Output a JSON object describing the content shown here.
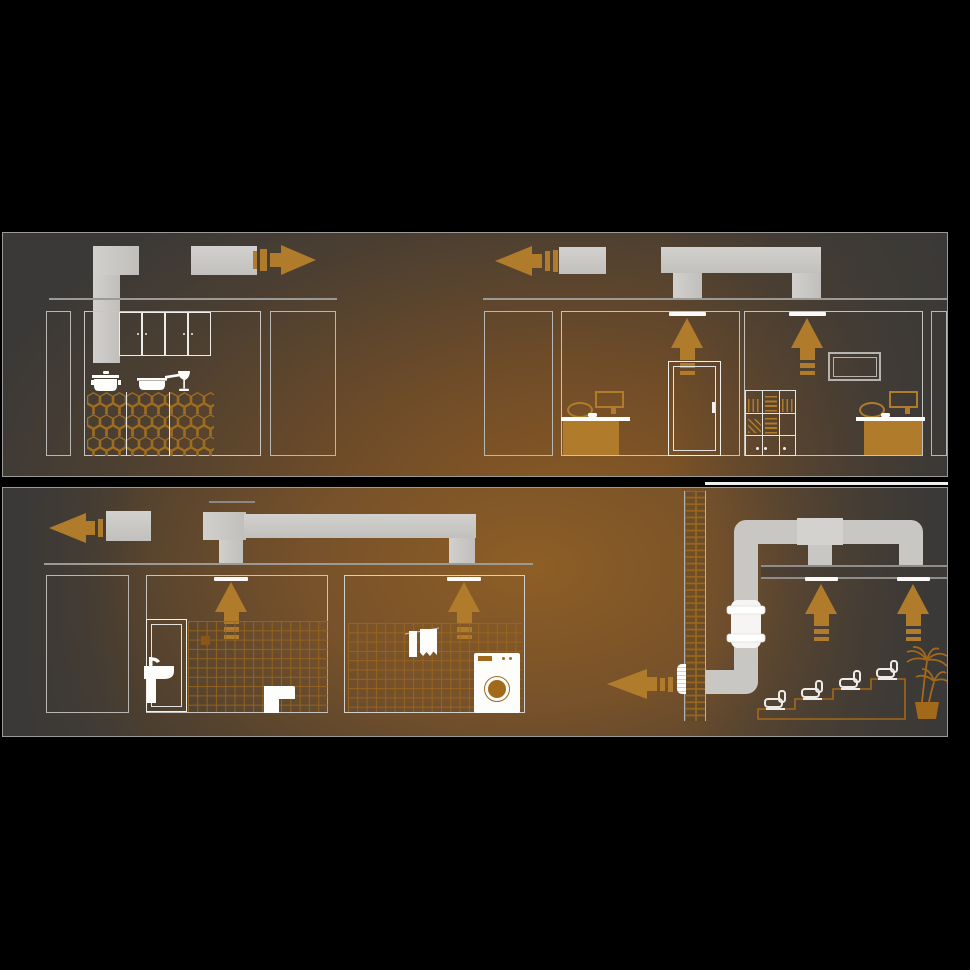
{
  "palette": {
    "accent": "#b07b2b",
    "duct_gray": "#c8c6c3",
    "panel_dark": "#3b3937",
    "glow_orange": "#8a5a23",
    "white": "#fbfaf9",
    "line_gray": "#9c9a97",
    "fixture_white": "#fdfdfc",
    "tile_line": "#9b671d",
    "plant_orange": "#a2691b",
    "page_background": "#000000"
  },
  "panels": [
    {
      "name": "upper-floor",
      "scenes": [
        {
          "name": "kitchen",
          "airflow": "extracted via cooker-hood duct, exhausted to the right",
          "icons": [
            "cooker-hood-duct",
            "exhaust-duct",
            "airflow-arrow-right",
            "wall-cabinets",
            "cooking-pot",
            "frying-pan",
            "wine-glass",
            "hex-tiled-counter"
          ]
        },
        {
          "name": "offices",
          "airflow": "two ceiling vents into overhead duct, exhausted to the left",
          "icons": [
            "airflow-arrow-left",
            "exhaust-duct",
            "ceiling-duct-run",
            "ceiling-vent",
            "extract-arrow-up",
            "office-door",
            "desk",
            "office-chair",
            "monitor",
            "bookshelf",
            "tv-frame"
          ]
        }
      ]
    },
    {
      "name": "lower-floor",
      "scenes": [
        {
          "name": "bathrooms",
          "airflow": "two ceiling vents into overhead duct, exhausted to the left",
          "icons": [
            "airflow-arrow-left",
            "exhaust-duct",
            "ceiling-duct-run",
            "ceiling-vent",
            "extract-arrow-up",
            "bathroom-door",
            "washbasin",
            "toilet",
            "wall-tiles",
            "towels",
            "washing-machine"
          ]
        },
        {
          "name": "auditorium",
          "airflow": "two ceiling vents, inline duct fan on riser, exhausted left through tiled shaft wall",
          "icons": [
            "tiled-shaft-wall",
            "inline-duct-fan",
            "duct-elbow",
            "duct-tee",
            "ceiling-vent",
            "extract-arrow-up",
            "wall-grille",
            "airflow-arrow-left",
            "stepped-seating",
            "seat",
            "potted-palm"
          ]
        }
      ]
    }
  ],
  "counts": {
    "ceiling_vents_upper": 2,
    "ceiling_vents_lower": 4,
    "extract_arrows_up": 6,
    "exhaust_outlets": 4,
    "seats": 4,
    "inline_fans": 1
  }
}
